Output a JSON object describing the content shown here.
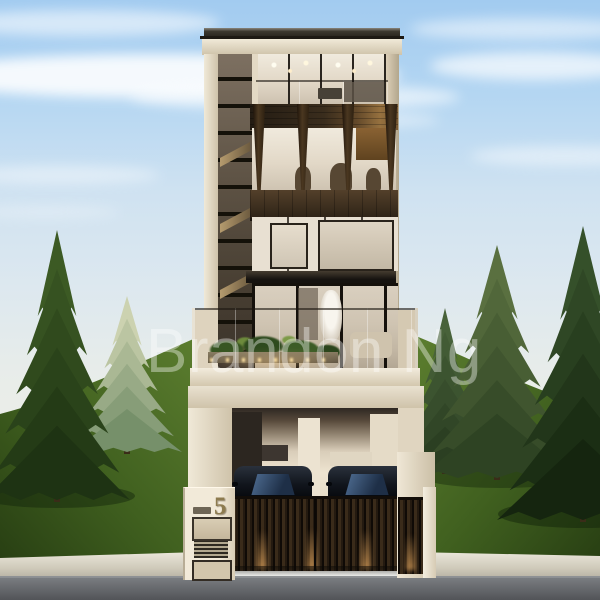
{
  "watermark": {
    "text": "Brandon Ng"
  },
  "house": {
    "number": "5"
  },
  "palette": {
    "sky_top": "#a2cbf0",
    "sky_mid": "#dde8ef",
    "sky_horizon": "#e9ede9",
    "grass_hi": "#5c7e2f",
    "grass_lo": "#283f13",
    "cream_hi": "#f0e9d8",
    "cream_lo": "#cfc3aa",
    "wood_hi": "#4a3720",
    "wood_lo": "#241a10",
    "frame": "#15110c",
    "gate_hi": "#3a2b1a",
    "gate_lo": "#241a10",
    "car_glass_hi": "#5b7da6",
    "car_glass_lo": "#1e2f47",
    "curb_hi": "#eae6da",
    "curb_lo": "#a9a496",
    "pavement_hi": "#7d8084",
    "pavement_lo": "#525458",
    "glow": "#ffba68",
    "number_color": "#8d7b4f",
    "watermark": "rgba(255,255,255,0.38)"
  },
  "scene": {
    "clouds": [
      {
        "x": -50,
        "y": 10,
        "w": 270,
        "h": 26,
        "o": 0.55
      },
      {
        "x": -80,
        "y": 54,
        "w": 480,
        "h": 44,
        "o": 0.88
      },
      {
        "x": 130,
        "y": 84,
        "w": 330,
        "h": 26,
        "o": 0.6
      },
      {
        "x": 410,
        "y": 18,
        "w": 230,
        "h": 22,
        "o": 0.5
      },
      {
        "x": 430,
        "y": 52,
        "w": 210,
        "h": 28,
        "o": 0.68
      },
      {
        "x": 250,
        "y": 112,
        "w": 190,
        "h": 16,
        "o": 0.45
      },
      {
        "x": -40,
        "y": 166,
        "w": 200,
        "h": 18,
        "o": 0.42
      },
      {
        "x": 470,
        "y": 146,
        "w": 190,
        "h": 20,
        "o": 0.45
      },
      {
        "x": -30,
        "y": 206,
        "w": 150,
        "h": 12,
        "o": 0.3
      }
    ],
    "shadows": [
      {
        "x": 57,
        "y": 496,
        "rx": 78,
        "ry": 12,
        "o": 0.45
      },
      {
        "x": 500,
        "y": 476,
        "rx": 80,
        "ry": 12,
        "o": 0.4
      },
      {
        "x": 583,
        "y": 514,
        "rx": 85,
        "ry": 14,
        "o": 0.5
      }
    ],
    "trees": [
      {
        "name": "tree-pale-left",
        "x": 127,
        "top": 296,
        "base": 452,
        "half": 55,
        "c1": "#ccd2b0",
        "c2": "#76906a"
      },
      {
        "name": "tree-large-left",
        "x": 57,
        "top": 230,
        "base": 500,
        "half": 73,
        "c1": "#3c5a24",
        "c2": "#1e3313"
      },
      {
        "name": "tree-small-right",
        "x": 445,
        "top": 308,
        "base": 472,
        "half": 48,
        "c1": "#48623a",
        "c2": "#2b3f22"
      },
      {
        "name": "tree-mid-right",
        "x": 497,
        "top": 245,
        "base": 478,
        "half": 78,
        "c1": "#5a7040",
        "c2": "#2e4323"
      },
      {
        "name": "tree-large-right",
        "x": 583,
        "top": 226,
        "base": 520,
        "half": 86,
        "c1": "#35502a",
        "c2": "#15250f"
      }
    ]
  }
}
